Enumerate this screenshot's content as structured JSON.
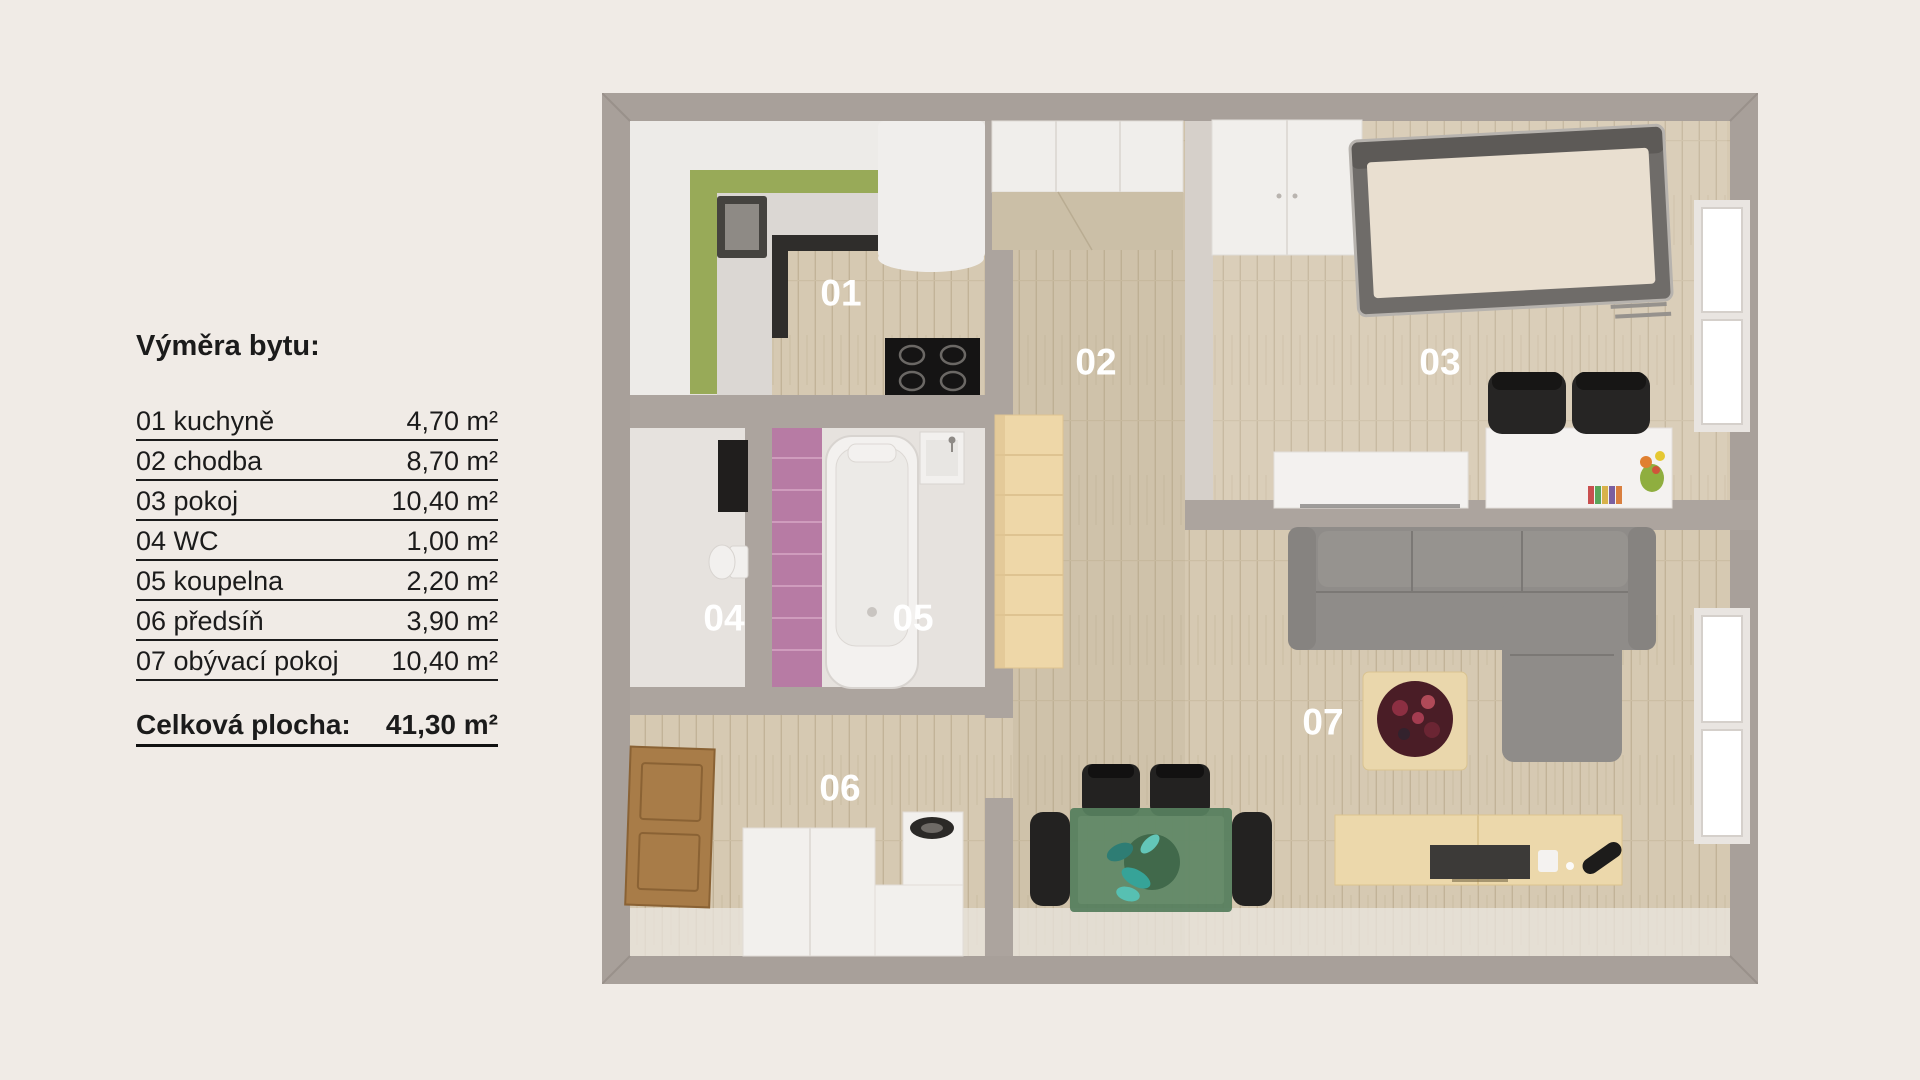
{
  "legend": {
    "title": "Výměra bytu:",
    "rows": [
      {
        "label": "01 kuchyně",
        "value": "4,70 m²"
      },
      {
        "label": "02 chodba",
        "value": "8,70 m²"
      },
      {
        "label": "03 pokoj",
        "value": "10,40 m²"
      },
      {
        "label": "04 WC",
        "value": "1,00 m²"
      },
      {
        "label": "05 koupelna",
        "value": "2,20 m²"
      },
      {
        "label": "06 předsíň",
        "value": "3,90 m²"
      },
      {
        "label": "07 obývací pokoj",
        "value": "10,40 m²"
      }
    ],
    "total_label": "Celková plocha:",
    "total_value": "41,30 m²"
  },
  "floorplan": {
    "room_labels": [
      {
        "id": "01",
        "name": "kuchyně"
      },
      {
        "id": "02",
        "name": "chodba"
      },
      {
        "id": "03",
        "name": "pokoj"
      },
      {
        "id": "04",
        "name": "WC"
      },
      {
        "id": "05",
        "name": "koupelna"
      },
      {
        "id": "06",
        "name": "předsíň"
      },
      {
        "id": "07",
        "name": "obývací pokoj"
      }
    ],
    "colors": {
      "background": "#f0ebe6",
      "wall": "#a8a09a",
      "inner_wall": "#aca49e",
      "floor_wood": "#d6c9b2",
      "hallway_tint": "#b09f83",
      "kitchen_green": "#98aa58",
      "bathroom_pink": "#b77ba4",
      "sofa_gray": "#8f8c89",
      "dining_green": "#567e5e",
      "wood_furniture": "#ecd8ab",
      "door_brown": "#a87c48",
      "label_white": "#ffffff",
      "text_dark": "#1b1b1b"
    }
  }
}
